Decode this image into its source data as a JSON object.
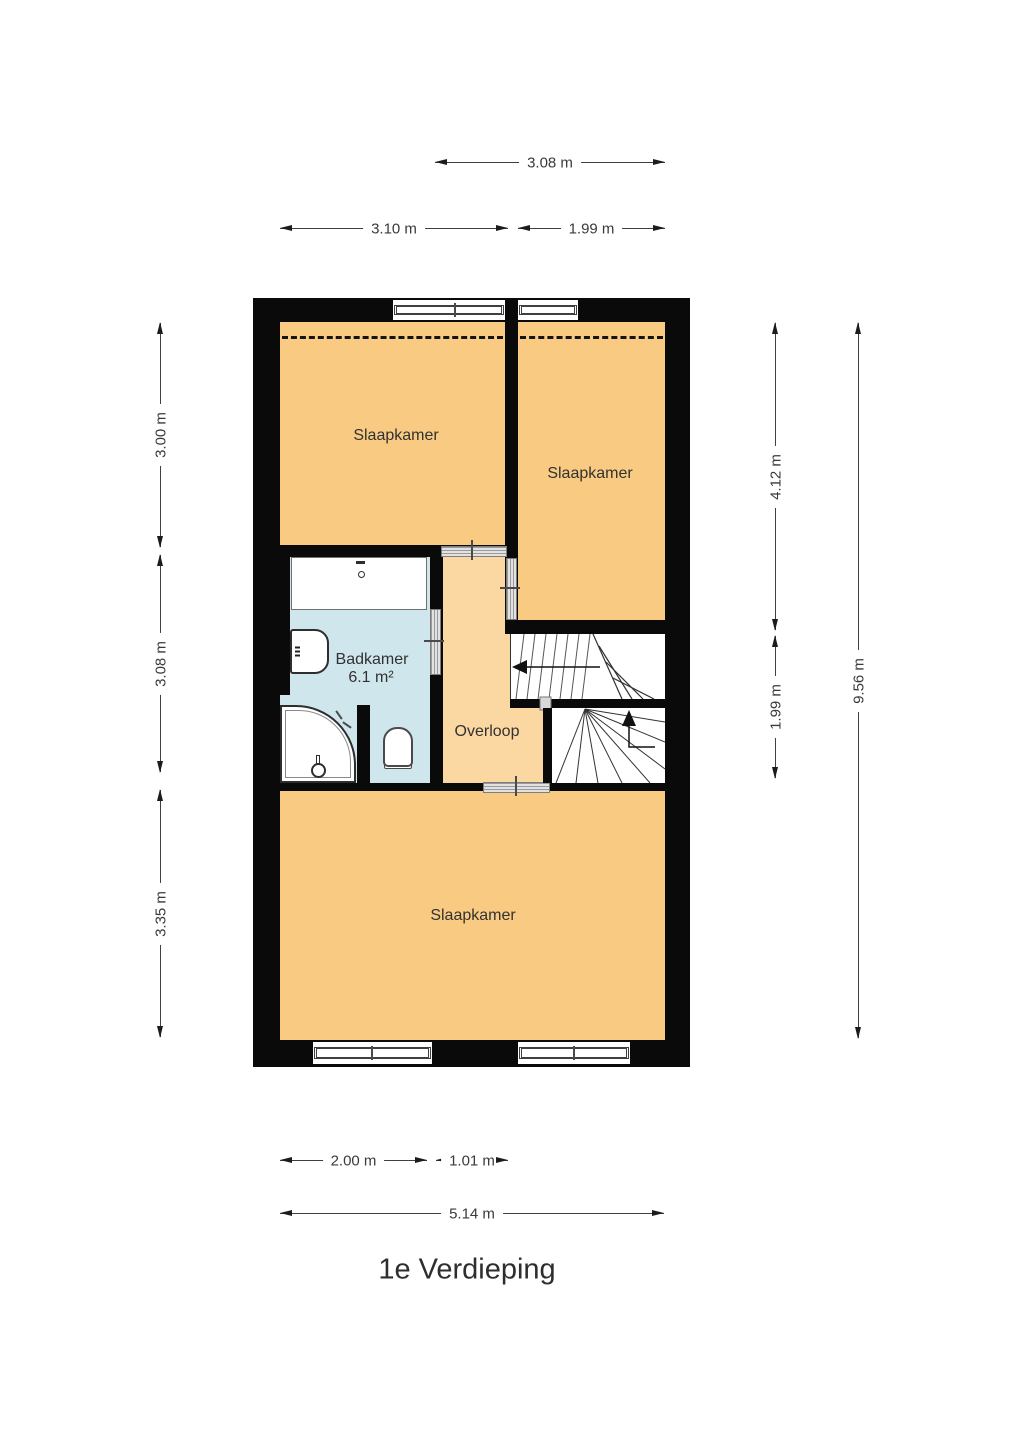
{
  "title": "1e Verdieping",
  "rooms": {
    "bedroom_top_left": "Slaapkamer",
    "bedroom_top_right": "Slaapkamer",
    "bedroom_bottom": "Slaapkamer",
    "bathroom": "Badkamer",
    "bathroom_area": "6.1 m²",
    "landing": "Overloop"
  },
  "dimensions": {
    "top_width": "3.08 m",
    "upper_left": "3.10 m",
    "upper_right": "1.99 m",
    "left_top": "3.00 m",
    "left_middle": "3.08 m",
    "left_bottom": "3.35 m",
    "right_inner_top": "4.12 m",
    "right_inner_bottom": "1.99 m",
    "right_total": "9.56 m",
    "bottom_left": "2.00 m",
    "bottom_center": "1.01 m",
    "bottom_total": "5.14 m"
  },
  "colors": {
    "wall": "#0a0a0a",
    "bedroom_fill": "#f8ca82",
    "landing_fill": "#fbd7a1",
    "bathroom_fill": "#cfe6ec",
    "door_gray": "#c9c9c9",
    "dimension_text": "#3a3a3a"
  }
}
